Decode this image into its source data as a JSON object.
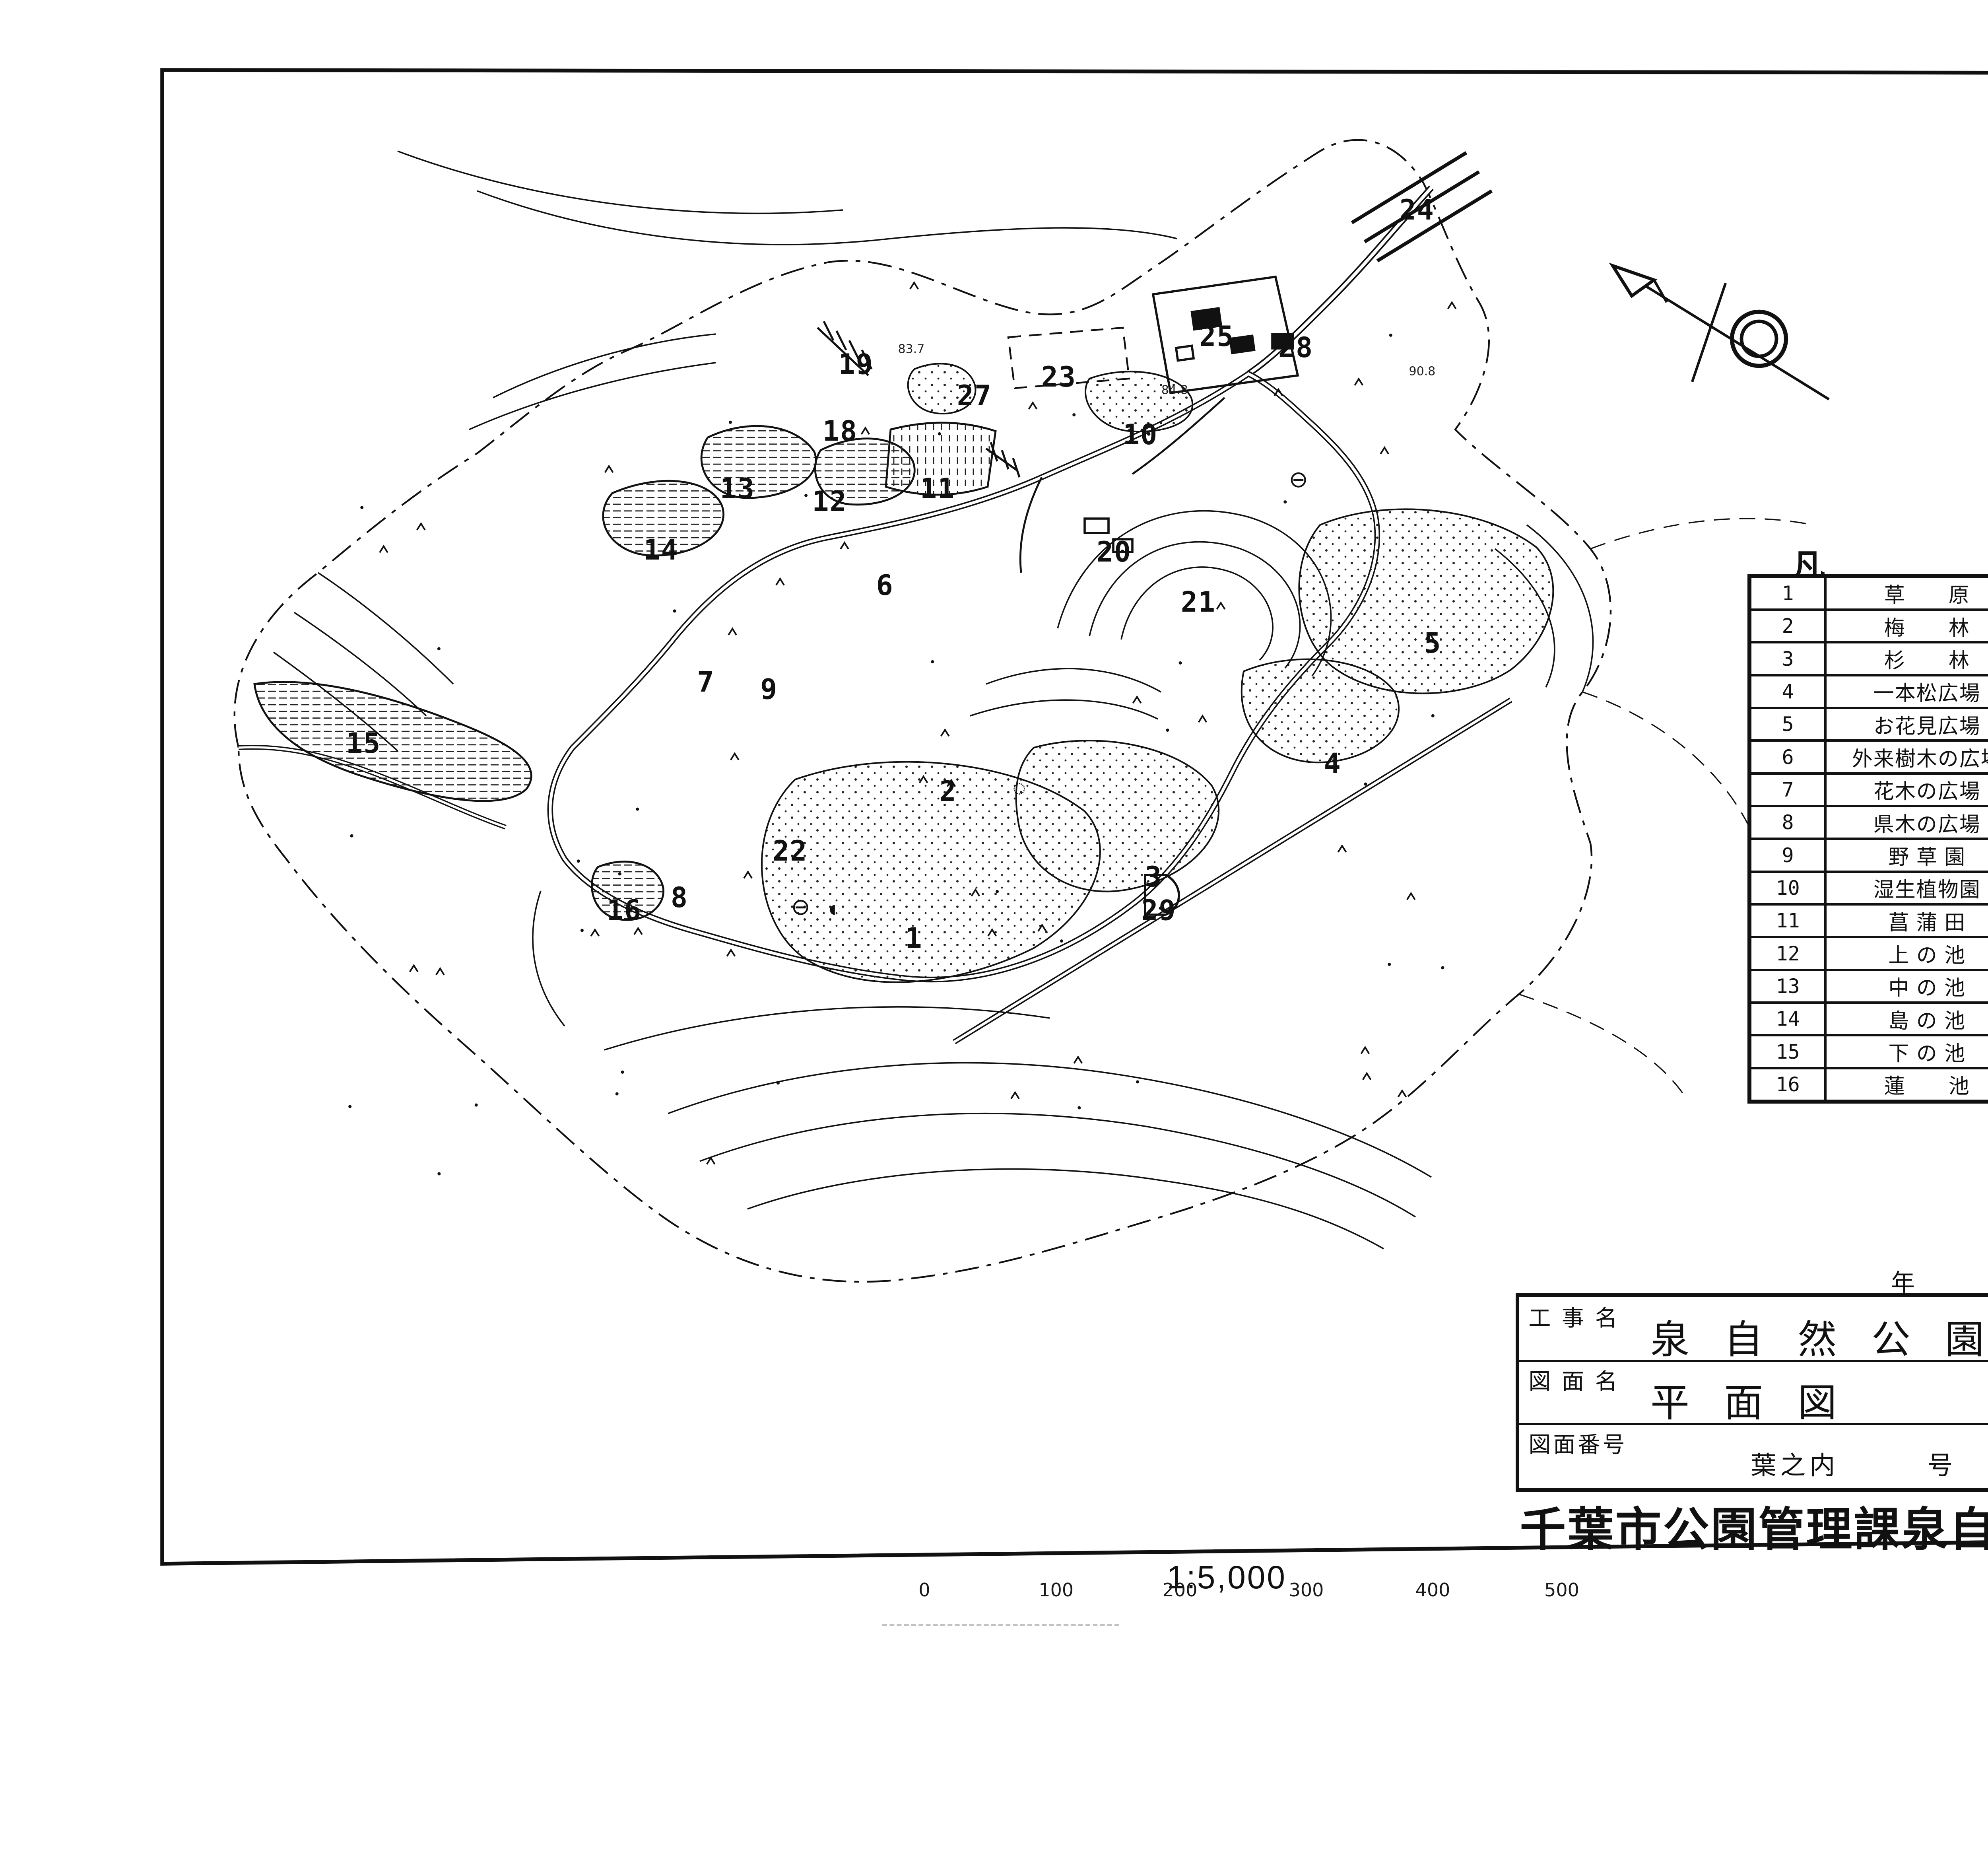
{
  "sheet": {
    "handwritten_number": "1181"
  },
  "legend": {
    "title_left": "凡",
    "title_right": "例",
    "left_items": [
      {
        "no": "1",
        "label": "草　　原"
      },
      {
        "no": "2",
        "label": "梅　　林"
      },
      {
        "no": "3",
        "label": "杉　　林"
      },
      {
        "no": "4",
        "label": "一本松広場"
      },
      {
        "no": "5",
        "label": "お花見広場"
      },
      {
        "no": "6",
        "label": "外来樹木の広場"
      },
      {
        "no": "7",
        "label": "花木の広場"
      },
      {
        "no": "8",
        "label": "県木の広場"
      },
      {
        "no": "9",
        "label": "野 草 園"
      },
      {
        "no": "10",
        "label": "湿生植物園"
      },
      {
        "no": "11",
        "label": "菖 蒲 田"
      },
      {
        "no": "12",
        "label": "上 の 池"
      },
      {
        "no": "13",
        "label": "中 の 池"
      },
      {
        "no": "14",
        "label": "島 の 池"
      },
      {
        "no": "15",
        "label": "下 の 池"
      },
      {
        "no": "16",
        "label": "蓮　　池"
      }
    ],
    "right_items": [
      {
        "no": "17",
        "label": "紅 葉 園"
      },
      {
        "no": "18",
        "label": "築　　山"
      },
      {
        "no": "19",
        "label": "そ像の広場"
      },
      {
        "no": "20",
        "label": "小動物小屋"
      },
      {
        "no": "21",
        "label": "野 鳥 の 森"
      },
      {
        "no": "22",
        "label": "も み じ 谷"
      },
      {
        "no": "23",
        "label": "駐 車 場 (一)"
      },
      {
        "no": "24",
        "label": "駐 車 場 (二)"
      },
      {
        "no": "25",
        "label": "管理事務所"
      },
      {
        "no": "26",
        "label": "いずみばし"
      },
      {
        "no": "27",
        "label": "売　　店"
      },
      {
        "no": "28",
        "label": "サイクリングセンター"
      },
      {
        "no": "29",
        "label": "焼 却 場"
      },
      {
        "no": "◐",
        "label": "水 飲 み"
      },
      {
        "no": "⊖",
        "label": "便　　所"
      },
      {
        "no": "",
        "label": ""
      }
    ]
  },
  "title_block": {
    "date_labels": [
      "年",
      "月",
      "日"
    ],
    "row1_label": "工 事 名",
    "row1_value": "泉 自 然 公 園",
    "row2_label": "図 面 名",
    "row2_value": "平 面 図",
    "scale_label": "縮尺",
    "scale_value": "1:5,000",
    "row3_label": "図面番号",
    "row3_value": "葉之内　　　号",
    "designer_label": "設計者",
    "designer_value": ":",
    "organization": "千葉市公園管理課泉自然公園事務所"
  },
  "scale_bar": {
    "ratio_text": "1:5,000",
    "ticks": [
      {
        "t": "0",
        "x": 35.1
      },
      {
        "t": "100",
        "x": 40.1
      },
      {
        "t": "200",
        "x": 44.8
      },
      {
        "t": "300",
        "x": 49.6
      },
      {
        "t": "400",
        "x": 54.4
      },
      {
        "t": "500",
        "x": 59.3
      }
    ]
  },
  "map": {
    "labels": [
      {
        "no": "24",
        "x": 53.8,
        "y": 11.3
      },
      {
        "no": "25",
        "x": 46.2,
        "y": 18.1
      },
      {
        "no": "28",
        "x": 49.2,
        "y": 18.7
      },
      {
        "no": "19",
        "x": 32.5,
        "y": 19.6
      },
      {
        "no": "23",
        "x": 40.2,
        "y": 20.3
      },
      {
        "no": "27",
        "x": 37.0,
        "y": 21.3
      },
      {
        "no": "18",
        "x": 31.9,
        "y": 23.2
      },
      {
        "no": "10",
        "x": 43.3,
        "y": 23.4
      },
      {
        "no": "13",
        "x": 28.0,
        "y": 26.3
      },
      {
        "no": "12",
        "x": 31.5,
        "y": 27.0
      },
      {
        "no": "11",
        "x": 35.6,
        "y": 26.3
      },
      {
        "no": "14",
        "x": 25.1,
        "y": 29.6
      },
      {
        "no": "20",
        "x": 42.3,
        "y": 29.7
      },
      {
        "no": "6",
        "x": 33.6,
        "y": 31.5
      },
      {
        "no": "21",
        "x": 45.5,
        "y": 32.4
      },
      {
        "no": "5",
        "x": 54.4,
        "y": 34.6
      },
      {
        "no": "7",
        "x": 26.8,
        "y": 36.7
      },
      {
        "no": "9",
        "x": 29.2,
        "y": 37.1
      },
      {
        "no": "15",
        "x": 13.8,
        "y": 40.0
      },
      {
        "no": "4",
        "x": 50.6,
        "y": 41.1
      },
      {
        "no": "2",
        "x": 36.0,
        "y": 42.6
      },
      {
        "no": "22",
        "x": 30.0,
        "y": 45.8
      },
      {
        "no": "3",
        "x": 43.8,
        "y": 47.2
      },
      {
        "no": "8",
        "x": 25.8,
        "y": 48.3
      },
      {
        "no": "16",
        "x": 23.7,
        "y": 49.0
      },
      {
        "no": "29",
        "x": 44.0,
        "y": 49.0
      },
      {
        "no": "1",
        "x": 34.7,
        "y": 50.5
      }
    ],
    "symbols": [
      {
        "glyph": "⊖",
        "name": "toilet-symbol",
        "x": 30.4,
        "y": 48.8
      },
      {
        "glyph": "◐",
        "name": "water-fountain-symbol",
        "x": 31.7,
        "y": 48.9
      },
      {
        "glyph": "⊖",
        "name": "toilet-symbol",
        "x": 49.3,
        "y": 25.8
      },
      {
        "glyph": "◌",
        "name": "structure-symbol",
        "x": 38.7,
        "y": 42.4
      }
    ],
    "spot_elevations": [
      {
        "v": "83.7",
        "x": 34.6,
        "y": 18.8
      },
      {
        "v": "90.8",
        "x": 54.0,
        "y": 20.0
      },
      {
        "v": "84.8",
        "x": 44.6,
        "y": 21.0
      }
    ]
  }
}
